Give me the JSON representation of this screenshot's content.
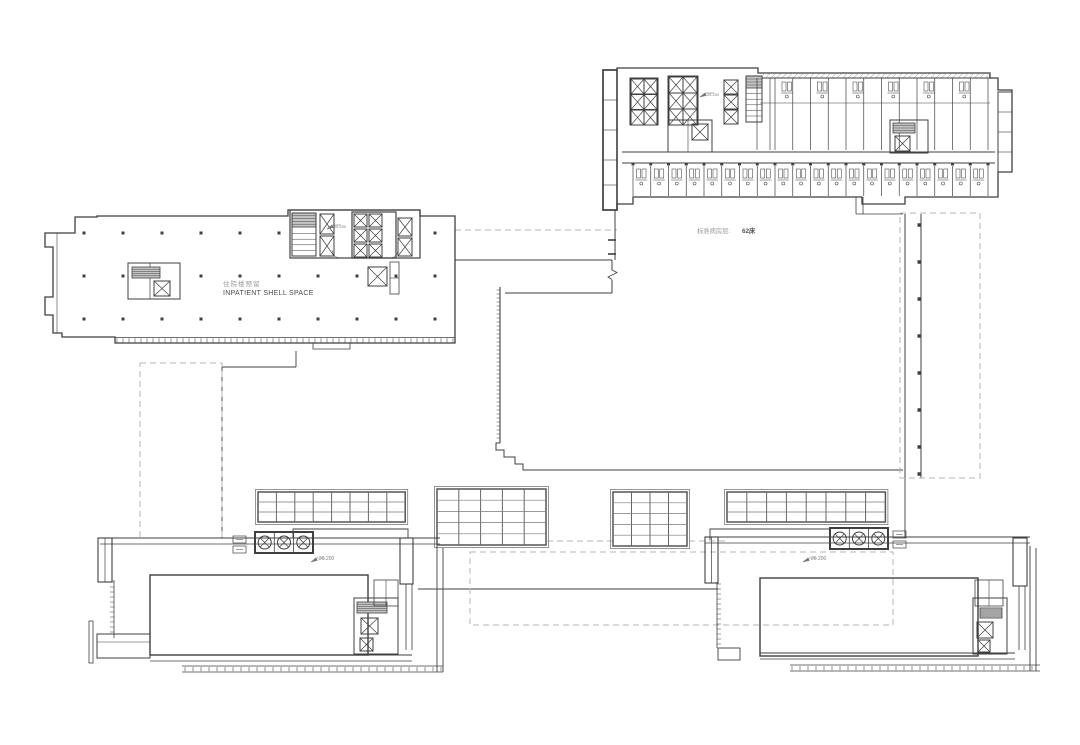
{
  "title": "hospital-campus-floor-plan",
  "colors": {
    "background": "#ffffff",
    "line": "#3f3f3f",
    "gray_line": "#8a8a8a",
    "dashed": "#b5b5b5",
    "hatch": "#c6c6c6",
    "text_dark": "#4a4a4a",
    "text_gray": "#9a9a9a"
  },
  "labels": {
    "shell_space_cn": "住院楼预留",
    "shell_space_en": "INPATIENT SHELL SPACE",
    "ward_floor_prefix": "标准病房层: ",
    "ward_floor_beds": "62床"
  },
  "level_markers": {
    "building_a": "26.200",
    "building_b": "26.200",
    "podium_left": "26.200",
    "podium_right": "26.200"
  }
}
